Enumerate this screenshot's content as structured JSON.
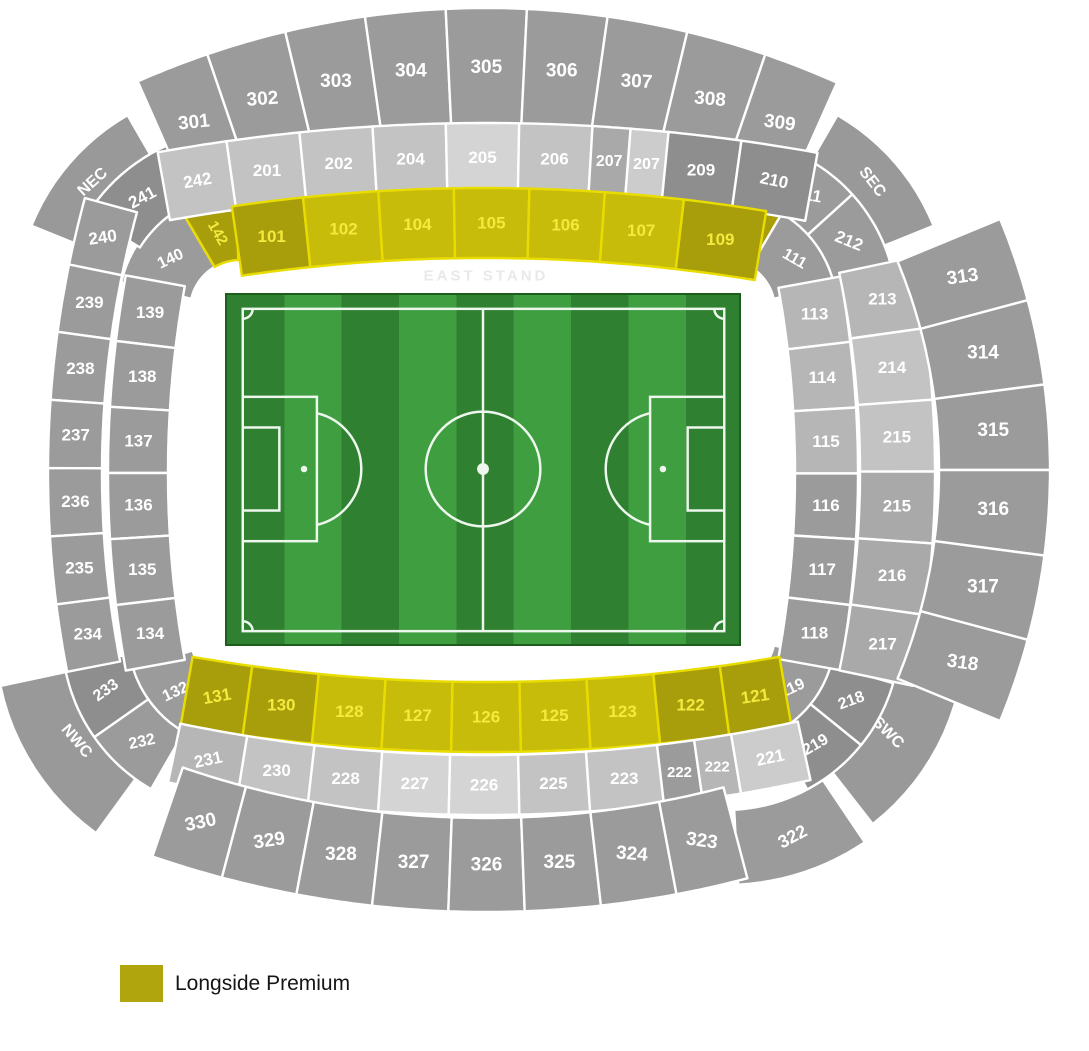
{
  "stand_label": "EAST STAND",
  "legend": {
    "label": "Longside Premium",
    "swatch_color": "#b1a50d"
  },
  "colors": {
    "g1": "#9b9b9b",
    "g2": "#8e8e8e",
    "gc": "#999999",
    "g3": "#c3c3c3",
    "g4": "#d4d4d4",
    "g5": "#b6b6b6",
    "g6": "#cccccc",
    "gm": "#a9a9a9",
    "y1": "#c8bc0a",
    "y2": "#a89e0c",
    "yellow_stroke": "#e9dd00",
    "gray_stroke": "#ffffff",
    "label_on_yellow": "#f4ea3e",
    "label_on_gray": "#ffffff"
  },
  "pitch": {
    "stripes": 9,
    "stripe_dark": "#2f8030",
    "stripe_light": "#3f9e40",
    "line_color": "#eef7ee",
    "border_color": "#1d5e1d"
  },
  "stadium": {
    "bands": [
      {
        "id": "nec",
        "cx": 240,
        "cy": 310,
        "rIn": 160,
        "rOut": 225,
        "t0": -68,
        "t1": -30,
        "labelR": 195,
        "sections": [
          {
            "label": "NEC",
            "w": 1,
            "c": "gc",
            "rot": -42,
            "fs": 16,
            "corner": true
          }
        ]
      },
      {
        "id": "sec",
        "cx": 725,
        "cy": 310,
        "rIn": 160,
        "rOut": 225,
        "t0": 30,
        "t1": 68,
        "labelR": 195,
        "sections": [
          {
            "label": "SEC",
            "w": 1,
            "c": "gc",
            "rot": 52,
            "fs": 16,
            "corner": true
          }
        ]
      },
      {
        "id": "nwc",
        "cx": 240,
        "cy": 635,
        "rIn": 170,
        "rOut": 245,
        "t0": 216,
        "t1": 258,
        "labelR": 195,
        "sections": [
          {
            "label": "NWC",
            "w": 1,
            "c": "gc",
            "rot": 50,
            "fs": 16,
            "corner": true
          }
        ]
      },
      {
        "id": "swc",
        "cx": 725,
        "cy": 635,
        "rIn": 165,
        "rOut": 240,
        "t0": 100,
        "t1": 142,
        "labelR": 190,
        "sections": [
          {
            "label": "SWC",
            "w": 1,
            "c": "gc",
            "rot": 45,
            "fs": 16,
            "corner": true
          }
        ]
      },
      {
        "id": "tl-100",
        "cx": 240,
        "cy": 310,
        "rIn": 50,
        "rOut": 122,
        "t0": -77,
        "t1": -2,
        "fs": 16,
        "sections": [
          {
            "label": "140",
            "w": 0.62,
            "c": "g1",
            "rot": -25
          },
          {
            "label": "142",
            "w": 0.38,
            "c": "y2",
            "rot": 60,
            "labelR": 80,
            "fs": 15
          }
        ]
      },
      {
        "id": "tr-100",
        "cx": 725,
        "cy": 310,
        "rIn": 50,
        "rOut": 122,
        "t0": 2,
        "t1": 77,
        "fs": 16,
        "sections": [
          {
            "label": "110",
            "w": 0.38,
            "c": "y2",
            "rot": 85,
            "labelR": 80,
            "fs": 15
          },
          {
            "label": "111",
            "w": 0.62,
            "c": "g1",
            "rot": 30
          }
        ]
      },
      {
        "id": "tl-200",
        "cx": 240,
        "cy": 310,
        "rIn": 118,
        "rOut": 180,
        "t0": -58,
        "t1": -24,
        "fs": 17,
        "sections": [
          {
            "label": "241",
            "w": 1,
            "c": "g2",
            "rot": -28
          }
        ]
      },
      {
        "id": "tr-200",
        "cx": 725,
        "cy": 310,
        "rIn": 112,
        "rOut": 172,
        "t0": 24,
        "t1": 74,
        "fs": 17,
        "sections": [
          {
            "label": "211",
            "w": 0.95,
            "c": "g1",
            "rot": 10
          },
          {
            "label": "212",
            "w": 1.05,
            "c": "g1",
            "rot": 22
          }
        ]
      },
      {
        "id": "bl-100",
        "cx": 240,
        "cy": 635,
        "rIn": 50,
        "rOut": 122,
        "t0": 205,
        "t1": 252,
        "fs": 16,
        "sections": [
          {
            "label": "132",
            "w": 1,
            "c": "g1",
            "rot": -25
          }
        ]
      },
      {
        "id": "bl-200",
        "cx": 240,
        "cy": 635,
        "rIn": 112,
        "rOut": 178,
        "t0": 210,
        "t1": 260,
        "fs": 16,
        "sections": [
          {
            "label": "232",
            "w": 0.5,
            "c": "g1",
            "rot": -12
          },
          {
            "label": "233",
            "w": 0.5,
            "c": "g2",
            "rot": -35
          }
        ]
      },
      {
        "id": "br-100",
        "cx": 725,
        "cy": 635,
        "rIn": 50,
        "rOut": 122,
        "t0": 102,
        "t1": 155,
        "fs": 16,
        "sections": [
          {
            "label": "119",
            "w": 1,
            "c": "g1",
            "rot": -25
          }
        ]
      },
      {
        "id": "br-200",
        "cx": 725,
        "cy": 635,
        "rIn": 110,
        "rOut": 175,
        "t0": 106,
        "t1": 152,
        "fs": 16,
        "sections": [
          {
            "label": "218",
            "w": 1,
            "c": "g2",
            "rot": -20
          },
          {
            "label": "219",
            "w": 1,
            "c": "g2",
            "rot": -30
          }
        ]
      },
      {
        "id": "br-300",
        "cx": 725,
        "cy": 635,
        "rIn": 175,
        "rOut": 250,
        "t0": 146,
        "t1": 177,
        "fs": 18,
        "sections": [
          {
            "label": "322",
            "w": 1,
            "c": "g1",
            "rot": -28
          }
        ]
      },
      {
        "id": "east-300",
        "cx": 486,
        "cy": 871,
        "rIn": 744,
        "rOut": 863,
        "t0": -23.8,
        "t1": 24,
        "fs": 19,
        "sections": [
          {
            "label": "301",
            "w": 0.92,
            "c": "g1",
            "rot": -6
          },
          {
            "label": "302",
            "w": 1,
            "c": "g1",
            "rot": -4
          },
          {
            "label": "303",
            "w": 1,
            "c": "g1"
          },
          {
            "label": "304",
            "w": 1,
            "c": "g1"
          },
          {
            "label": "305",
            "w": 1,
            "c": "g1"
          },
          {
            "label": "306",
            "w": 1,
            "c": "g1"
          },
          {
            "label": "307",
            "w": 1,
            "c": "g1",
            "rot": 3
          },
          {
            "label": "308",
            "w": 1,
            "c": "g1",
            "rot": 5
          },
          {
            "label": "309",
            "w": 0.95,
            "c": "g1",
            "rot": 8
          }
        ]
      },
      {
        "id": "east-200",
        "cx": 486,
        "cy": 1977,
        "rIn": 1785,
        "rOut": 1854,
        "t0": -10.2,
        "t1": 10.3,
        "fs": 17,
        "sections": [
          {
            "label": "242",
            "w": 0.95,
            "c": "g3",
            "rot": -10
          },
          {
            "label": "201",
            "w": 1,
            "c": "g3"
          },
          {
            "label": "202",
            "w": 1,
            "c": "g3"
          },
          {
            "label": "204",
            "w": 1,
            "c": "g3"
          },
          {
            "label": "205",
            "w": 1,
            "c": "g4"
          },
          {
            "label": "206",
            "w": 1,
            "c": "g3"
          },
          {
            "label": "207",
            "w": 0.52,
            "c": "gm",
            "fs": 16
          },
          {
            "label": "207",
            "w": 0.52,
            "c": "g6",
            "fs": 16
          },
          {
            "label": "209",
            "w": 1,
            "c": "g2"
          },
          {
            "label": "210",
            "w": 1.05,
            "c": "g2",
            "rot": 12
          }
        ]
      },
      {
        "id": "east-100",
        "cx": 484,
        "cy": 1925,
        "rIn": 1667,
        "rOut": 1737,
        "t0": -8.35,
        "t1": 9.35,
        "fs": 17,
        "sections": [
          {
            "label": "101",
            "w": 0.95,
            "c": "y2"
          },
          {
            "label": "102",
            "w": 1,
            "c": "y1"
          },
          {
            "label": "104",
            "w": 1,
            "c": "y1"
          },
          {
            "label": "105",
            "w": 1,
            "c": "y1"
          },
          {
            "label": "106",
            "w": 1,
            "c": "y1"
          },
          {
            "label": "107",
            "w": 1.05,
            "c": "y1"
          },
          {
            "label": "109",
            "w": 1.1,
            "c": "y2"
          }
        ]
      },
      {
        "id": "south-100",
        "cx": -245,
        "cy": 473,
        "rIn": 1040,
        "rOut": 1103,
        "t0": 79.74,
        "t1": 100.3,
        "fs": 17,
        "sections": [
          {
            "label": "113",
            "w": 1,
            "c": "g5"
          },
          {
            "label": "114",
            "w": 1,
            "c": "g5"
          },
          {
            "label": "115",
            "w": 1,
            "c": "g5"
          },
          {
            "label": "116",
            "w": 1,
            "c": "g1"
          },
          {
            "label": "117",
            "w": 1,
            "c": "g1"
          },
          {
            "label": "118",
            "w": 1,
            "c": "g1"
          }
        ]
      },
      {
        "id": "south-200",
        "cx": -102,
        "cy": 472,
        "rIn": 962,
        "rOut": 1037,
        "t0": 78.05,
        "t1": 101.9,
        "fs": 17,
        "sections": [
          {
            "label": "213",
            "w": 1,
            "c": "g5"
          },
          {
            "label": "214",
            "w": 1,
            "c": "g3"
          },
          {
            "label": "215",
            "w": 1,
            "c": "g3"
          },
          {
            "label": "215",
            "w": 1,
            "c": "gm"
          },
          {
            "label": "216",
            "w": 1,
            "c": "gm"
          },
          {
            "label": "217",
            "w": 1,
            "c": "gm"
          }
        ]
      },
      {
        "id": "south-300",
        "cx": 394,
        "cy": 470,
        "rIn": 545,
        "rOut": 656,
        "t0": 67.5,
        "t1": 112.5,
        "fs": 19,
        "sections": [
          {
            "label": "313",
            "w": 1,
            "c": "g1",
            "rot": -8
          },
          {
            "label": "314",
            "w": 1,
            "c": "g1"
          },
          {
            "label": "315",
            "w": 1,
            "c": "g1"
          },
          {
            "label": "316",
            "w": 1,
            "c": "g1"
          },
          {
            "label": "317",
            "w": 1,
            "c": "g1"
          },
          {
            "label": "318",
            "w": 1,
            "c": "g1",
            "rot": 8
          }
        ]
      },
      {
        "id": "west-100",
        "cx": 486,
        "cy": -1042,
        "rIn": 1724,
        "rOut": 1794,
        "t0": 189.8,
        "t1": 170.2,
        "fs": 17,
        "sections": [
          {
            "label": "131",
            "w": 0.9,
            "c": "y2",
            "rot": -10
          },
          {
            "label": "130",
            "w": 1,
            "c": "y2"
          },
          {
            "label": "128",
            "w": 1,
            "c": "y1"
          },
          {
            "label": "127",
            "w": 1,
            "c": "y1"
          },
          {
            "label": "126",
            "w": 1,
            "c": "y1"
          },
          {
            "label": "125",
            "w": 1,
            "c": "y1"
          },
          {
            "label": "123",
            "w": 1,
            "c": "y1"
          },
          {
            "label": "122",
            "w": 1,
            "c": "y2"
          },
          {
            "label": "121",
            "w": 0.9,
            "c": "y2",
            "rot": -8
          }
        ]
      },
      {
        "id": "west-200",
        "cx": 484,
        "cy": -730,
        "rIn": 1485,
        "rOut": 1545,
        "t0": 191.8,
        "t1": 167.8,
        "fs": 17,
        "sections": [
          {
            "label": "231",
            "w": 1,
            "c": "g5",
            "rot": -12
          },
          {
            "label": "230",
            "w": 1,
            "c": "g3"
          },
          {
            "label": "228",
            "w": 1,
            "c": "g3"
          },
          {
            "label": "227",
            "w": 1,
            "c": "g4"
          },
          {
            "label": "226",
            "w": 1,
            "c": "g4"
          },
          {
            "label": "225",
            "w": 1,
            "c": "g3"
          },
          {
            "label": "223",
            "w": 1.05,
            "c": "g3"
          },
          {
            "label": "222",
            "w": 0.55,
            "c": "g1",
            "fs": 15
          },
          {
            "label": "222",
            "w": 0.55,
            "c": "g5",
            "fs": 15
          },
          {
            "label": "221",
            "w": 1,
            "c": "g6",
            "rot": -12
          }
        ]
      },
      {
        "id": "west-300",
        "cx": 486,
        "cy": -118,
        "rIn": 936,
        "rOut": 1030,
        "t0": 198.9,
        "t1": 165.3,
        "fs": 19,
        "sections": [
          {
            "label": "330",
            "w": 0.95,
            "c": "g1",
            "rot": -12
          },
          {
            "label": "329",
            "w": 1,
            "c": "g1",
            "rot": -8
          },
          {
            "label": "328",
            "w": 1,
            "c": "g1"
          },
          {
            "label": "327",
            "w": 1,
            "c": "g1"
          },
          {
            "label": "326",
            "w": 1,
            "c": "g1"
          },
          {
            "label": "325",
            "w": 1,
            "c": "g1"
          },
          {
            "label": "324",
            "w": 1,
            "c": "g1",
            "rot": 5
          },
          {
            "label": "323",
            "w": 0.95,
            "c": "g1",
            "rot": 8
          }
        ]
      },
      {
        "id": "north-200",
        "cx": 1090,
        "cy": 473,
        "rIn": 988,
        "rOut": 1042,
        "t0": 285.3,
        "t1": 259,
        "fs": 17,
        "sections": [
          {
            "label": "240",
            "w": 1,
            "c": "g1",
            "rot": -8
          },
          {
            "label": "239",
            "w": 1,
            "c": "g1"
          },
          {
            "label": "238",
            "w": 1,
            "c": "g1"
          },
          {
            "label": "237",
            "w": 1,
            "c": "g1"
          },
          {
            "label": "236",
            "w": 1,
            "c": "g1"
          },
          {
            "label": "235",
            "w": 1,
            "c": "g1"
          },
          {
            "label": "234",
            "w": 1,
            "c": "g1"
          }
        ]
      },
      {
        "id": "north-100",
        "cx": 1213,
        "cy": 473,
        "rIn": 1045,
        "rOut": 1105,
        "t0": 280.3,
        "t1": 259.7,
        "fs": 17,
        "sections": [
          {
            "label": "139",
            "w": 1,
            "c": "g1"
          },
          {
            "label": "138",
            "w": 1,
            "c": "g1"
          },
          {
            "label": "137",
            "w": 1,
            "c": "g1"
          },
          {
            "label": "136",
            "w": 1,
            "c": "g1"
          },
          {
            "label": "135",
            "w": 1,
            "c": "g1"
          },
          {
            "label": "134",
            "w": 1,
            "c": "g1"
          }
        ]
      }
    ]
  }
}
